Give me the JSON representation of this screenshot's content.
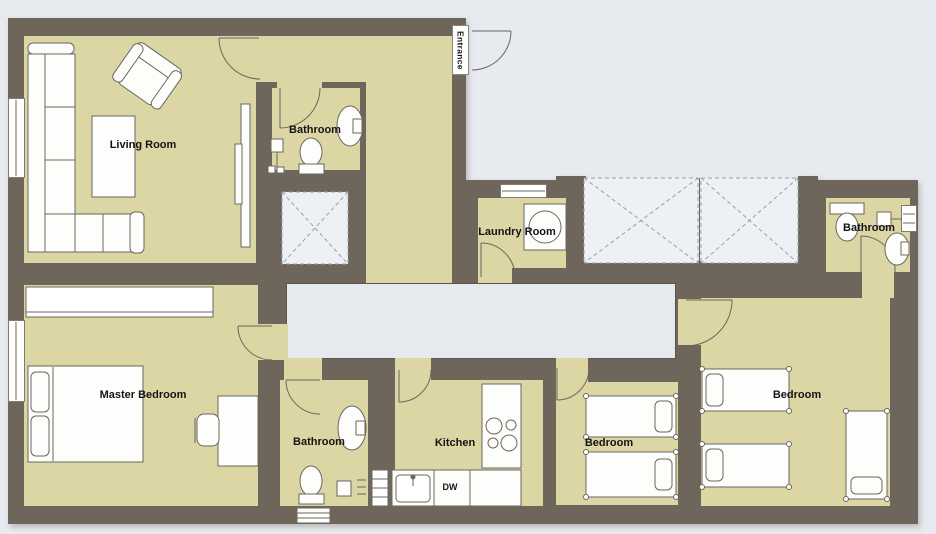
{
  "plan_type": "apartment-floor-plan",
  "rooms": {
    "living": {
      "label": "Living Room"
    },
    "bath_top": {
      "label": "Bathroom"
    },
    "entrance": {
      "label": "Entrance"
    },
    "laundry": {
      "label": "Laundry Room"
    },
    "bath_right": {
      "label": "Bathroom"
    },
    "master": {
      "label": "Master Bedroom"
    },
    "bath_bottom": {
      "label": "Bathroom"
    },
    "kitchen": {
      "label": "Kitchen"
    },
    "bedroom_mid": {
      "label": "Bedroom"
    },
    "bedroom_right": {
      "label": "Bedroom"
    }
  },
  "appliances": {
    "dishwasher": "DW"
  },
  "colors": {
    "wall": "#6e665a",
    "floor": "#dcd6a5",
    "outside": "#e7eaee",
    "hallway": "#e6eaee",
    "void_area": "#edf0f4",
    "furniture_outline": "#6a675f",
    "furniture_fill": "#fdfdfb",
    "label_text": "#141414"
  }
}
